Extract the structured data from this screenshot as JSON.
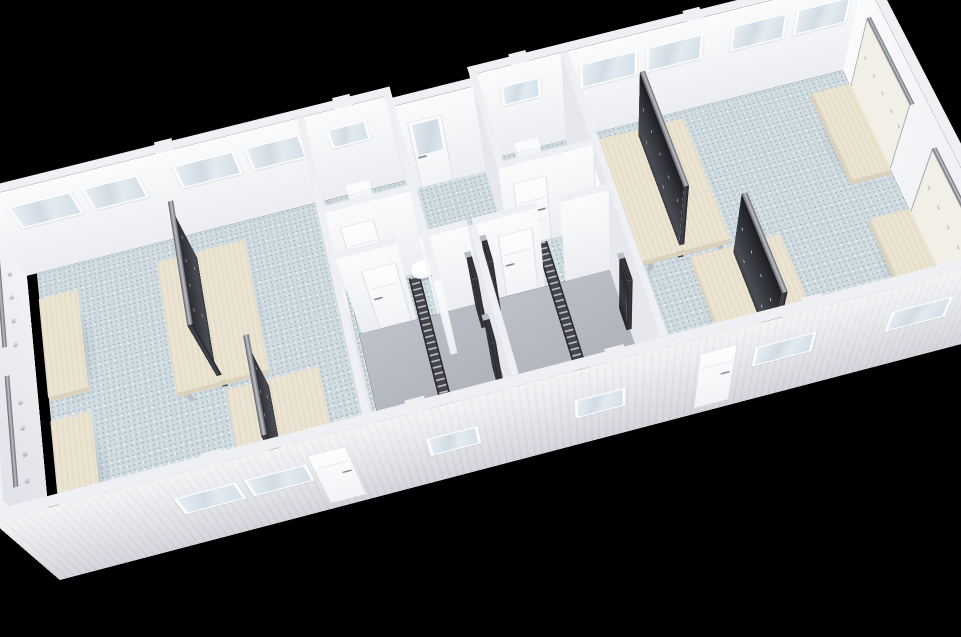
{
  "scene": {
    "description": "3D cutaway top-down rendering of a modular sanitary / changing-room building floating on a black background",
    "background_color": "#000000",
    "projection": "steep top-down 3D view, building long axis rising to the right"
  },
  "colors": {
    "background": "#000000",
    "floor_main": "#d0dbe0",
    "floor_shower": "#aeb0ba",
    "wall_interior": "#f6f7f9",
    "wall_side": "#e6e8ee",
    "wall_cap": "#eef0f3",
    "wall_exterior": "#e9eaee",
    "wood": "#ece4d2",
    "wood_edge": "#dcd2bc",
    "metal": "#b9bdc4",
    "rail_dark": "#33353b",
    "panel_dark": "#2c2e34",
    "door": "#fbfcfd",
    "glass": "#d8e2ea",
    "porcelain": "#ffffff"
  },
  "building": {
    "sections": [
      {
        "name": "changing-room-left",
        "floor": "light blue speckled",
        "island_double_benches": 2,
        "wall_benches": 2
      },
      {
        "name": "sanitary-core",
        "rooms": [
          {
            "name": "wc-left",
            "fixtures": [
              "toilet",
              "strip-window"
            ]
          },
          {
            "name": "entrance-lobby",
            "fixtures": [
              "glazed-entrance-door"
            ]
          },
          {
            "name": "wc-right",
            "fixtures": [
              "toilet",
              "strip-window"
            ]
          },
          {
            "name": "corridor",
            "fixtures": [
              "wall-washbasin",
              "interior-doors"
            ]
          },
          {
            "name": "shower-room-left",
            "floor": "grey wet-room",
            "fixtures": [
              "floor-mat",
              "shower-panel",
              "shower-panel",
              "strip-window"
            ]
          },
          {
            "name": "shower-room-right",
            "floor": "grey wet-room",
            "fixtures": [
              "floor-mat",
              "shower-panel",
              "shower-panel",
              "strip-window"
            ]
          }
        ]
      },
      {
        "name": "changing-room-right",
        "floor": "light blue speckled",
        "island_double_benches": 2,
        "wall_benches": 2
      }
    ],
    "exterior": {
      "cladding": "white ribbed modular panels with roof-joint tabs",
      "south_side": [
        "strip-window",
        "strip-window",
        "entrance-door",
        "shower-window",
        "shower-window",
        "entrance-door",
        "strip-window",
        "strip-window"
      ]
    }
  },
  "totals": {
    "benches": 8,
    "toilets": 2,
    "washbasins": 1,
    "shower_panels": 4,
    "floor_mats": 2,
    "doors_visible": 7,
    "windows_visible": 16
  }
}
